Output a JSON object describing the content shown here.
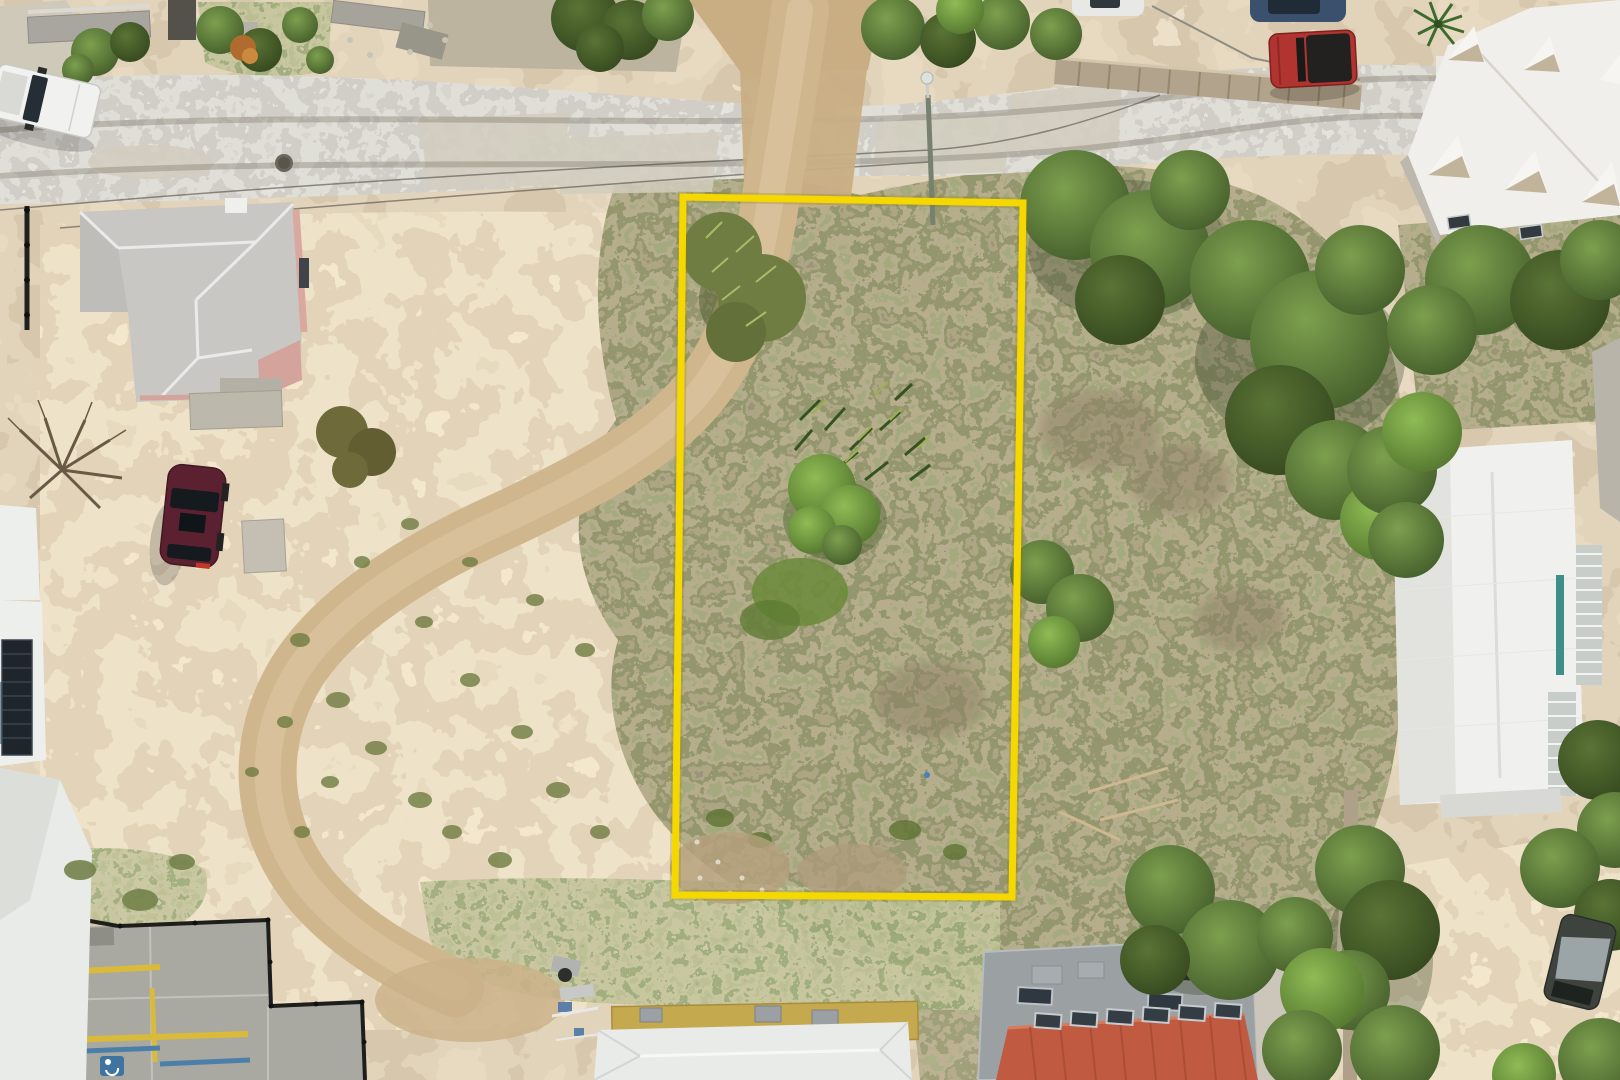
{
  "scene": {
    "type": "aerial-drone-photograph",
    "description": "Overhead drone photo of a vacant overgrown land parcel outlined with a yellow boundary rectangle, beside an open dirt lot with a looping dirt track, a concrete road along the top, surrounding houses with white, gray and red roofs, parked vehicles and dense scrub vegetation",
    "colors": {
      "boundary_yellow": "#F5D800",
      "dirt_field": "#CBB28A",
      "dirt_track": "#D2B98F",
      "scrub_brown": "#6C6143",
      "tree_green": "#567434",
      "road_concrete": "#B5B0A5"
    }
  },
  "boundary": {
    "label": "property-boundary-outline",
    "color": "#F5D800",
    "underlay_color": "#8A7A00",
    "points": "683,197 1023,203 1012,897 675,895",
    "stroke_width": 7
  },
  "vehicles": {
    "white_pickup": {
      "label": "white pickup truck",
      "color": "#F1F1EF"
    },
    "maroon_sedan": {
      "label": "maroon sedan",
      "color": "#5C2130"
    },
    "red_jeep": {
      "label": "red jeep with black soft top",
      "color": "#B23430",
      "top_color": "#23211F"
    },
    "blue_car": {
      "label": "dark blue car (edge of frame)",
      "color": "#3A506C"
    },
    "white_car": {
      "label": "white car (edge of frame)",
      "color": "#E8E8E6"
    },
    "derelict_vehicle": {
      "label": "derelict tarped vehicle",
      "color": "#3E433E"
    }
  },
  "buildings": {
    "left_house": {
      "label": "gray hip-roof house with pink walls",
      "roof_color": "#C9C7C3",
      "wall_color": "#D9A9A0"
    },
    "dormer_building": {
      "label": "large white building with pointed dormers",
      "roof_color": "#F0EFEB"
    },
    "right_white_building": {
      "label": "white hip-roof building with railings",
      "roof_color": "#F0F0EE"
    },
    "bottom_center_building": {
      "label": "white gable building with tan flat roof",
      "flat_roof_color": "#C5A94F",
      "roof_color": "#E9EBE9"
    },
    "red_roof_building": {
      "label": "gray concrete building with red metal roof",
      "roof_color": "#C05A40",
      "body_color": "#9BA0A3"
    },
    "parking_lot": {
      "label": "concrete parking lot with yellow and blue markings"
    }
  },
  "features": {
    "utility_pole": "street light pole",
    "manhole": "manhole cover in road",
    "dirt_track": "looping dirt access track",
    "stone_walls": "old stone walls and ruins",
    "black_fence": "black metal fence",
    "palm_tree": "palm tree",
    "debris_pile": "debris pile"
  }
}
